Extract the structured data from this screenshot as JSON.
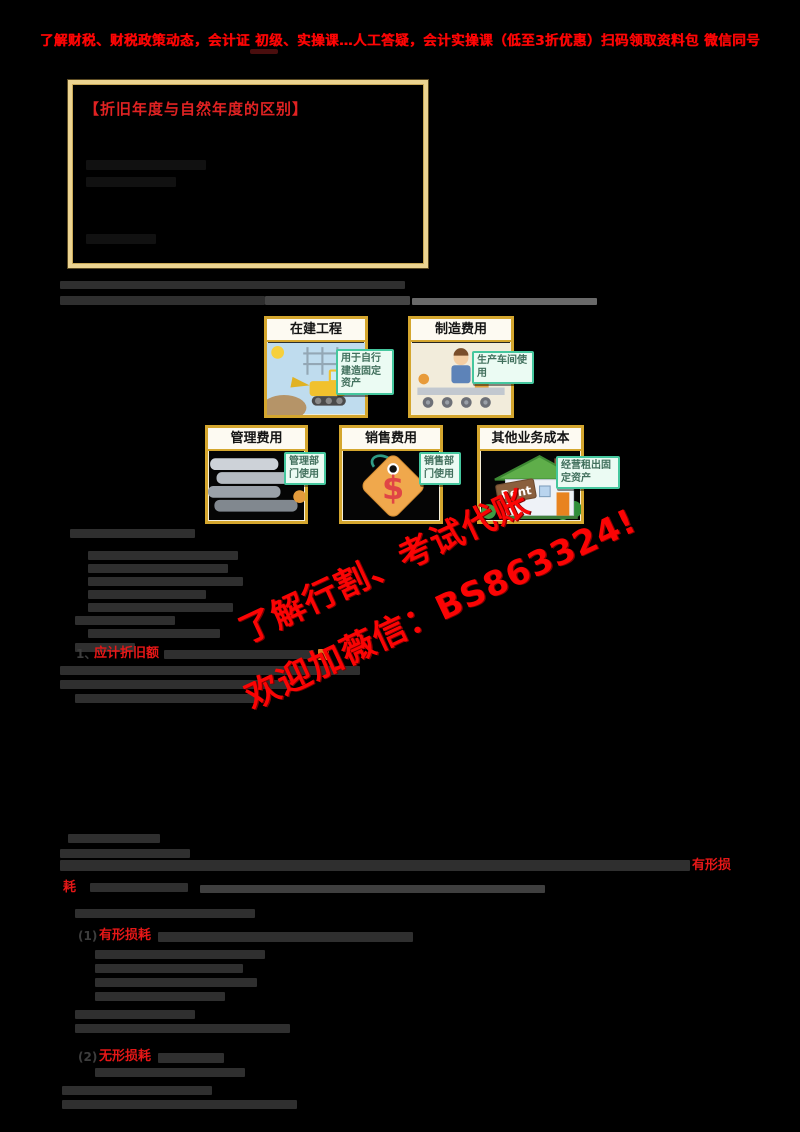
{
  "banner": {
    "text": "了解财税、财税政策动态，会计证 初级、实操课…人工答疑，会计实操课（低至3折优惠）扫码领取资料包 微信同号"
  },
  "info_box": {
    "title": "【折旧年度与自然年度的区别】"
  },
  "cards": [
    {
      "label": "在建工程",
      "note": "用于自行建造固定资产"
    },
    {
      "label": "制造费用",
      "note": "生产车间使用"
    },
    {
      "label": "管理费用",
      "note": "管理部门使用"
    },
    {
      "label": "销售费用",
      "note": "销售部门使用",
      "image_text": "$"
    },
    {
      "label": "其他业务成本",
      "note": "经营租出固定资产",
      "image_text": "Rent"
    }
  ],
  "watermark": {
    "line1": "了解行割、考试代账",
    "line2": "欢迎加薇信：BS863324!"
  },
  "inline": {
    "item_no": "1、",
    "item1_red": "应计折旧额",
    "para_red_tail": "有形损",
    "para_red_head": "耗",
    "p1_no": "(1)",
    "p1_red": "有形损耗",
    "p2_no": "(2)",
    "p2_red": "无形损耗"
  },
  "colors": {
    "accent_red": "#fe0000",
    "card_border": "#d4a62e",
    "note_border": "#45c79e",
    "box_border": "#ecd491"
  }
}
